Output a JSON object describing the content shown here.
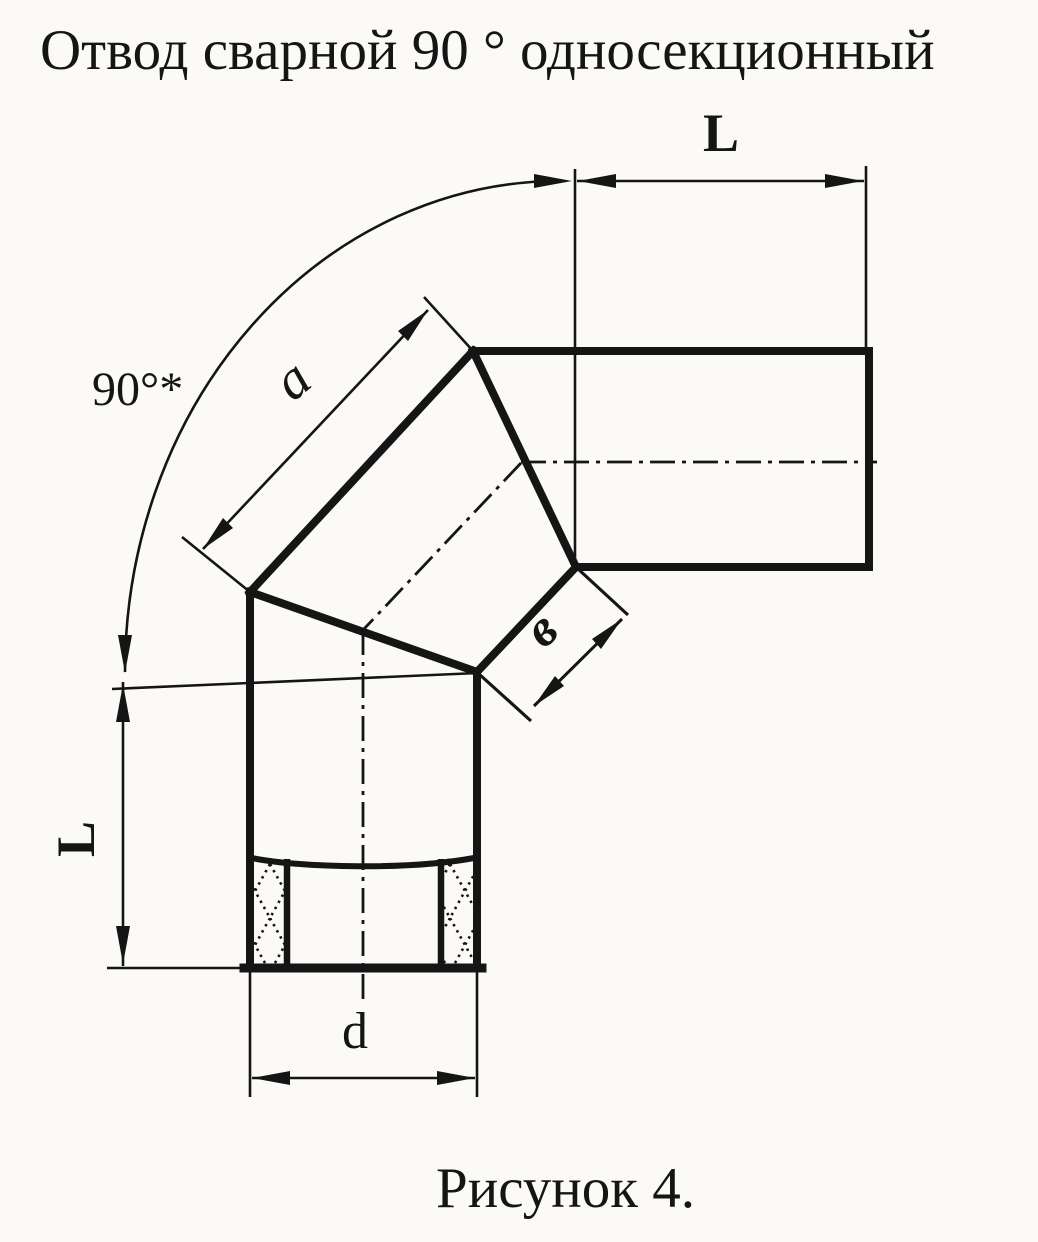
{
  "title": "Отвод сварной 90 ° односекционный",
  "figure_caption": "Рисунок 4.",
  "dimension_labels": {
    "angle": "90°*",
    "length_top": "L",
    "length_left": "L",
    "segment_a": "a",
    "segment_b": "в",
    "diameter_d": "d"
  },
  "colors": {
    "ink": "#151515",
    "paper": "#fbfaf7"
  }
}
